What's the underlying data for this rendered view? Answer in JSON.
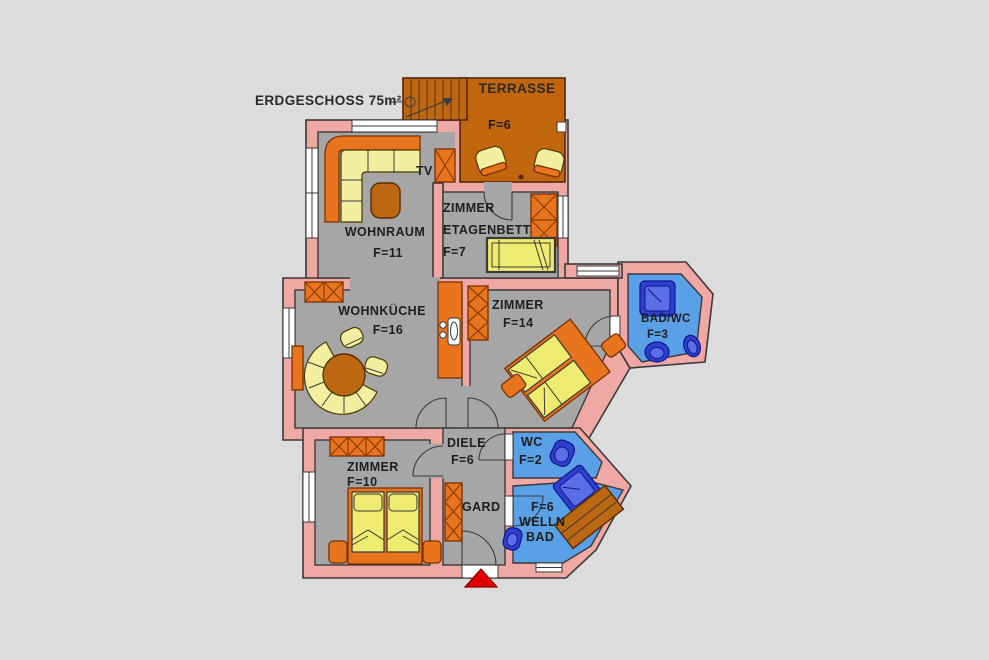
{
  "floor_plan": {
    "title": "ERDGESCHOSS 75m²",
    "rooms": {
      "terrasse": {
        "name": "TERRASSE",
        "area": "F=6"
      },
      "wohnraum": {
        "name": "WOHNRAUM",
        "area": "F=11"
      },
      "tv": {
        "label": "TV"
      },
      "zimmer_etagenbett": {
        "name_line1": "ZIMMER",
        "name_line2": "ETAGENBETT",
        "area": "F=7"
      },
      "wohnkueche": {
        "name": "WOHNKÜCHE",
        "area": "F=16"
      },
      "zimmer_ost": {
        "name": "ZIMMER",
        "area": "F=14"
      },
      "bad_wc": {
        "name": "BAD/WC",
        "area": "F=3"
      },
      "diele": {
        "name": "DIELE",
        "area": "F=6"
      },
      "wc": {
        "name": "WC",
        "area": "F=2"
      },
      "zimmer_sued": {
        "name": "ZIMMER",
        "area": "F=10"
      },
      "garderobe": {
        "name": "GARD"
      },
      "wellness_bad": {
        "area": "F=6",
        "name_line1": "WELLN",
        "name_line2": "BAD"
      }
    },
    "colors": {
      "background": "#dcdcdc",
      "wall": "#efa8a4",
      "floor": "#a6a6a6",
      "terrace": "#c2660e",
      "furniture_orange": "#e8741e",
      "furniture_yellow": "#f2f0a0",
      "mattress_yellow": "#eeeb70",
      "wood_brown": "#bc6712",
      "bath_blue": "#5aa0e6",
      "fixture_blue": "#2e3ed0",
      "entrance_marker_red": "#e00000",
      "outline": "#3a3a3a"
    }
  }
}
